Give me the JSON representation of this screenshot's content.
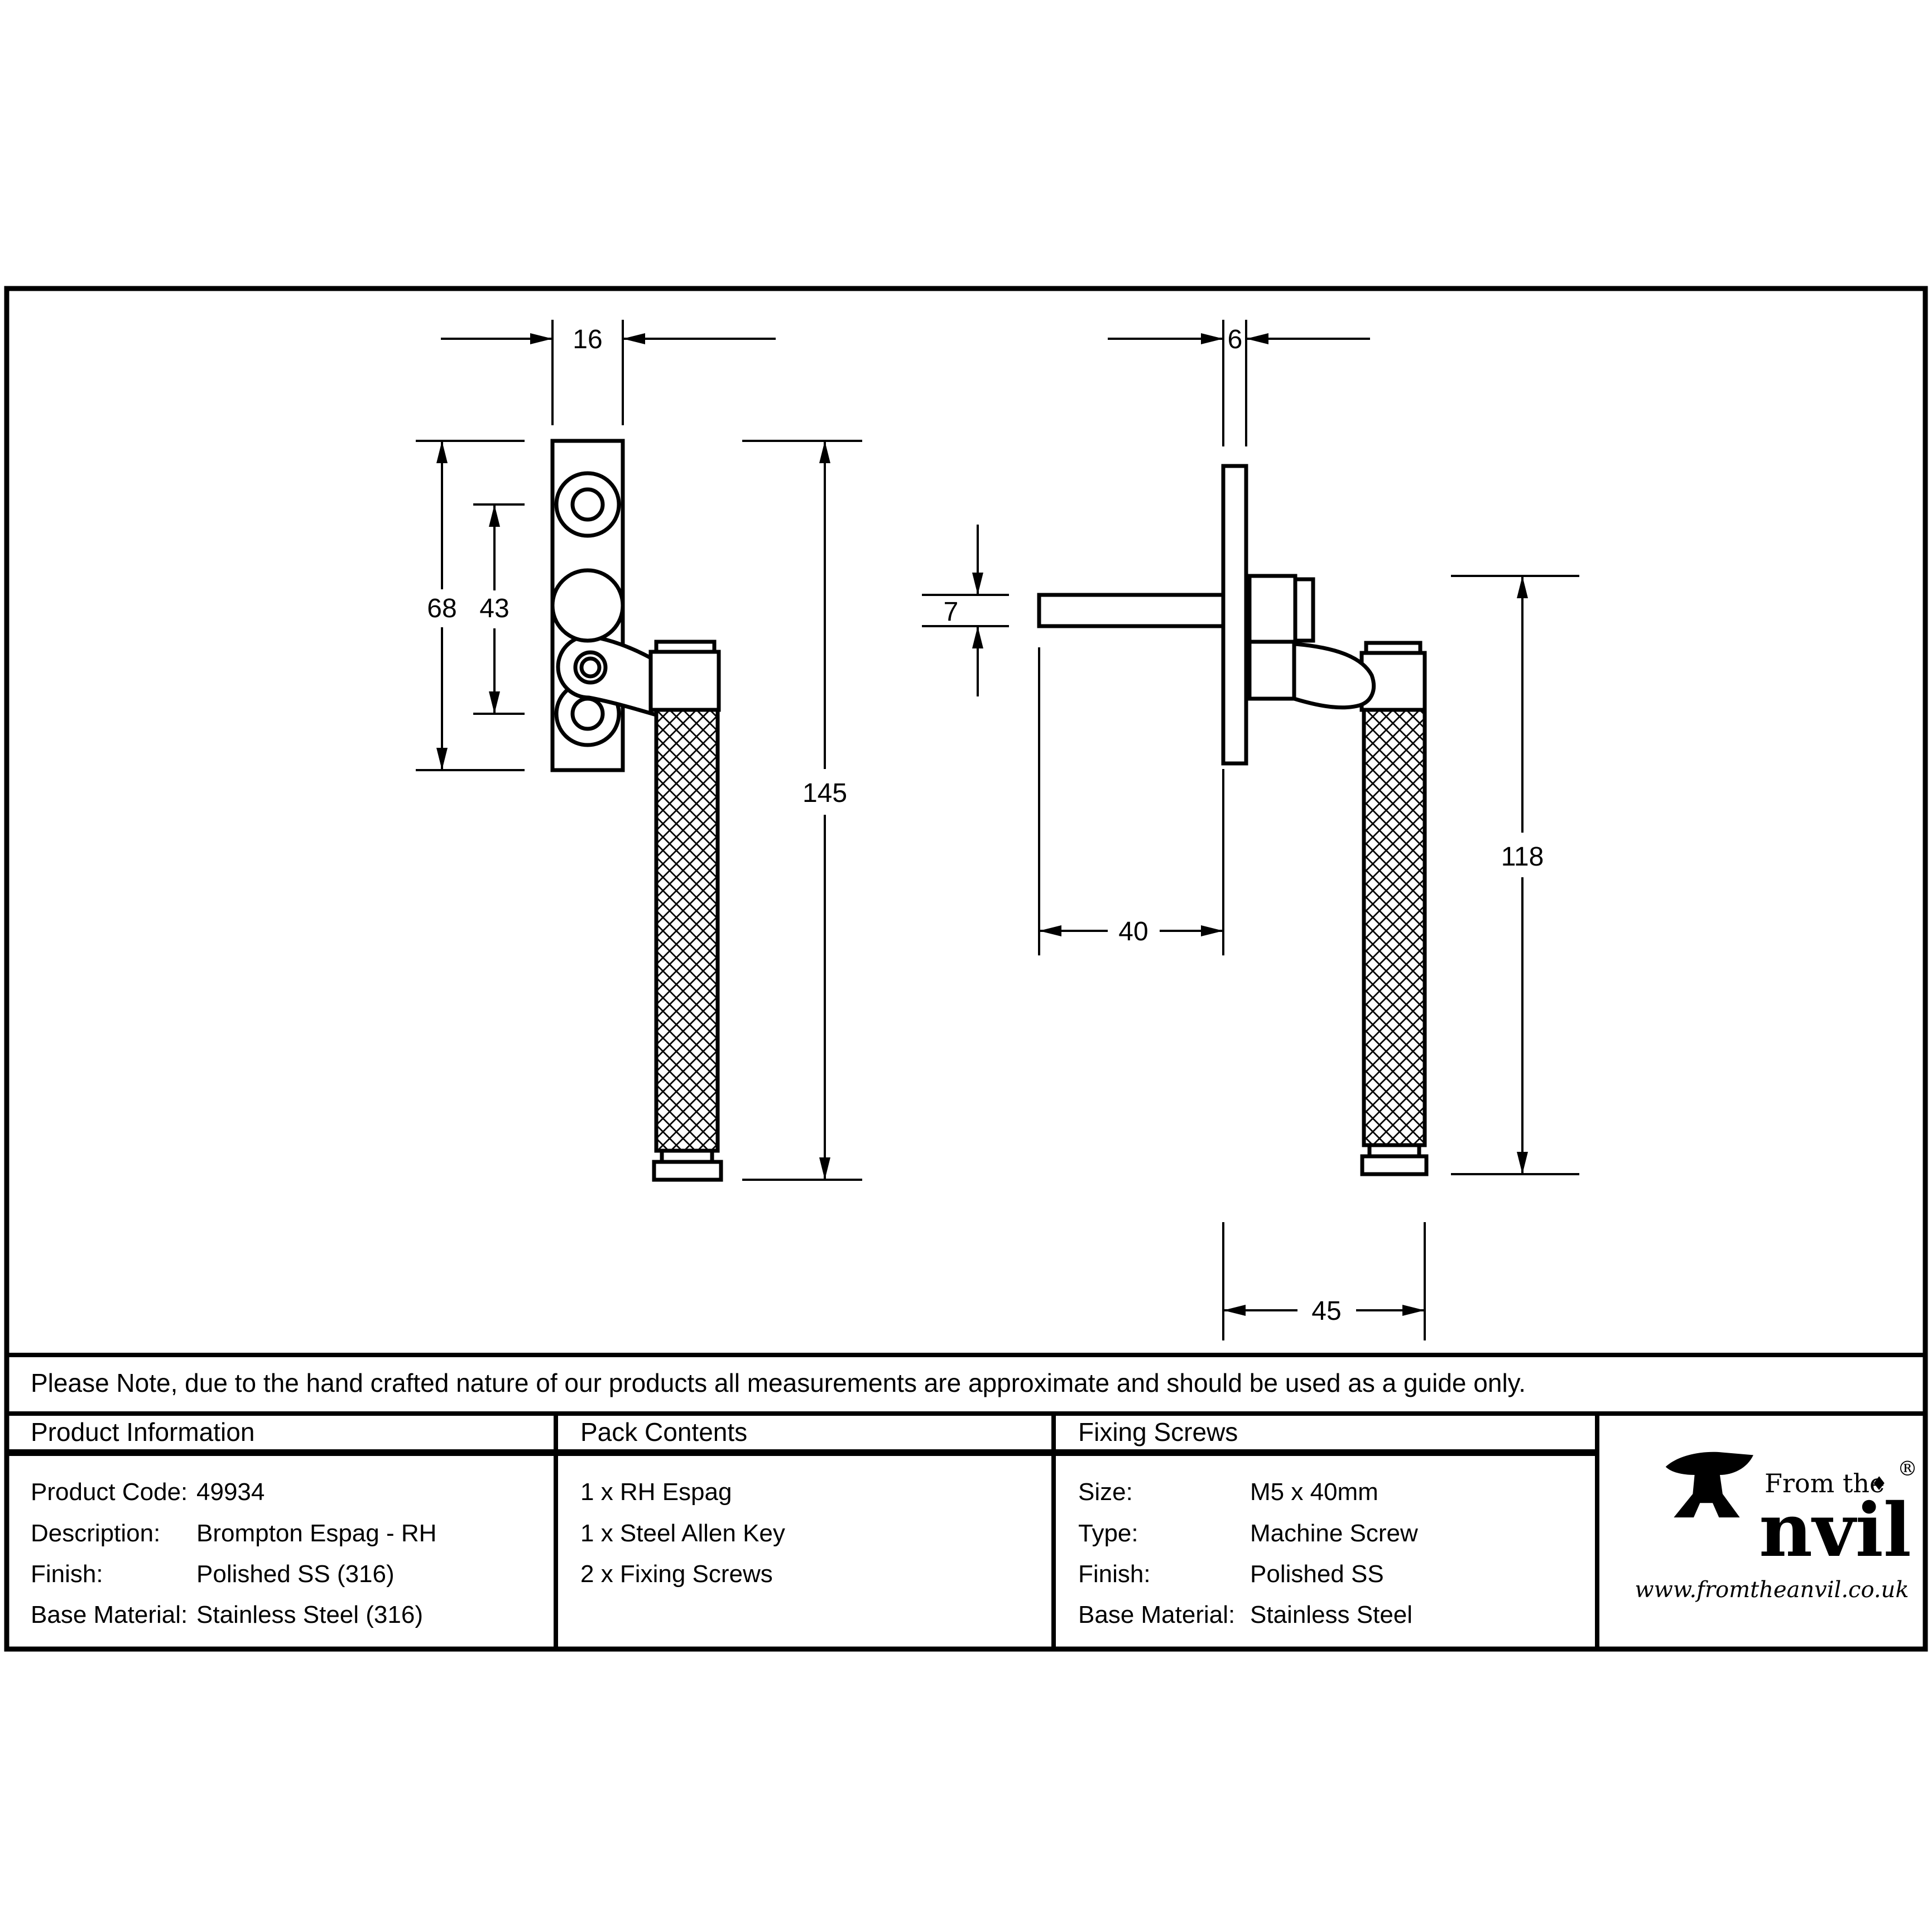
{
  "drawing": {
    "front_view": {
      "dims": {
        "plate_width": "16",
        "plate_height": "68",
        "hole_spacing": "43",
        "total_length": "145"
      }
    },
    "side_view": {
      "dims": {
        "plate_thickness": "6",
        "spindle_height": "7",
        "spindle_length": "40",
        "handle_length": "118",
        "projection": "45"
      }
    }
  },
  "note": "Please Note, due to the hand crafted nature of our products all measurements are approximate and should be used as a guide only.",
  "table": {
    "product_information": {
      "title": "Product Information",
      "rows": [
        {
          "label": "Product Code:",
          "value": "49934"
        },
        {
          "label": "Description:",
          "value": "Brompton Espag - RH"
        },
        {
          "label": "Finish:",
          "value": "Polished SS (316)"
        },
        {
          "label": "Base Material:",
          "value": "Stainless Steel (316)"
        }
      ]
    },
    "pack_contents": {
      "title": "Pack Contents",
      "items": [
        "1 x RH Espag",
        "1 x Steel Allen Key",
        "2 x Fixing Screws"
      ]
    },
    "fixing_screws": {
      "title": "Fixing Screws",
      "rows": [
        {
          "label": "Size:",
          "value": "M5 x 40mm"
        },
        {
          "label": "Type:",
          "value": "Machine Screw"
        },
        {
          "label": "Finish:",
          "value": "Polished SS"
        },
        {
          "label": "Base Material:",
          "value": "Stainless Steel"
        }
      ]
    }
  },
  "logo": {
    "prefix": "From the",
    "mark": "♦",
    "registered": "®",
    "name_rest": "nvil",
    "url": "www.fromtheanvil.co.uk"
  },
  "colors": {
    "ink": "#000000",
    "paper": "#ffffff"
  }
}
